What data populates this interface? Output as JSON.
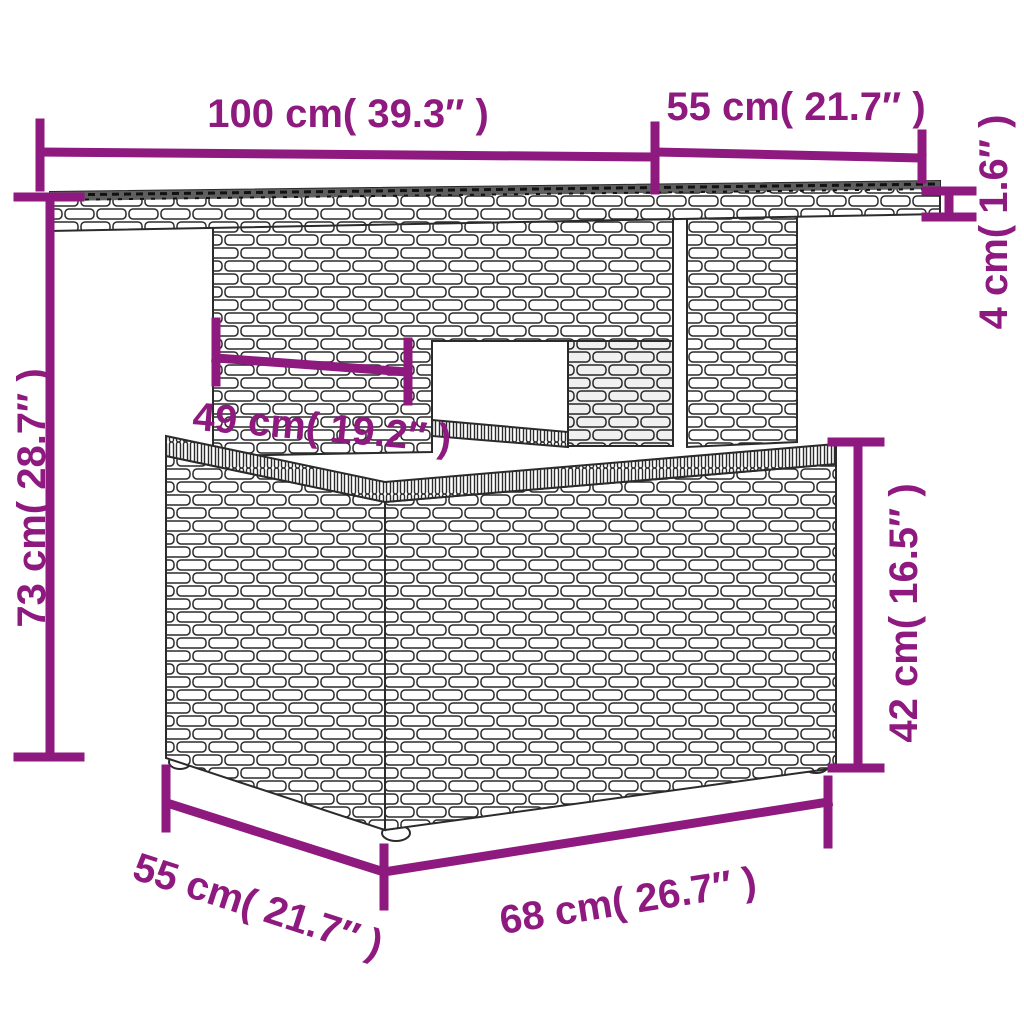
{
  "accent_color": "#8e1a80",
  "linework_color": "#2b2b2b",
  "illustration": "wicker-rattan-garden-table",
  "labels": {
    "top_width": "100 cm( 39.3″ )",
    "top_depth": "55 cm( 21.7″ )",
    "top_thickness": "4 cm( 1.6″ )",
    "overall_height": "73 cm( 28.7″ )",
    "understructure_width": "49 cm( 19.2″ )",
    "base_height": "42 cm( 16.5″ )",
    "base_depth": "55 cm( 21.7″ )",
    "base_width": "68 cm( 26.7″ )"
  }
}
